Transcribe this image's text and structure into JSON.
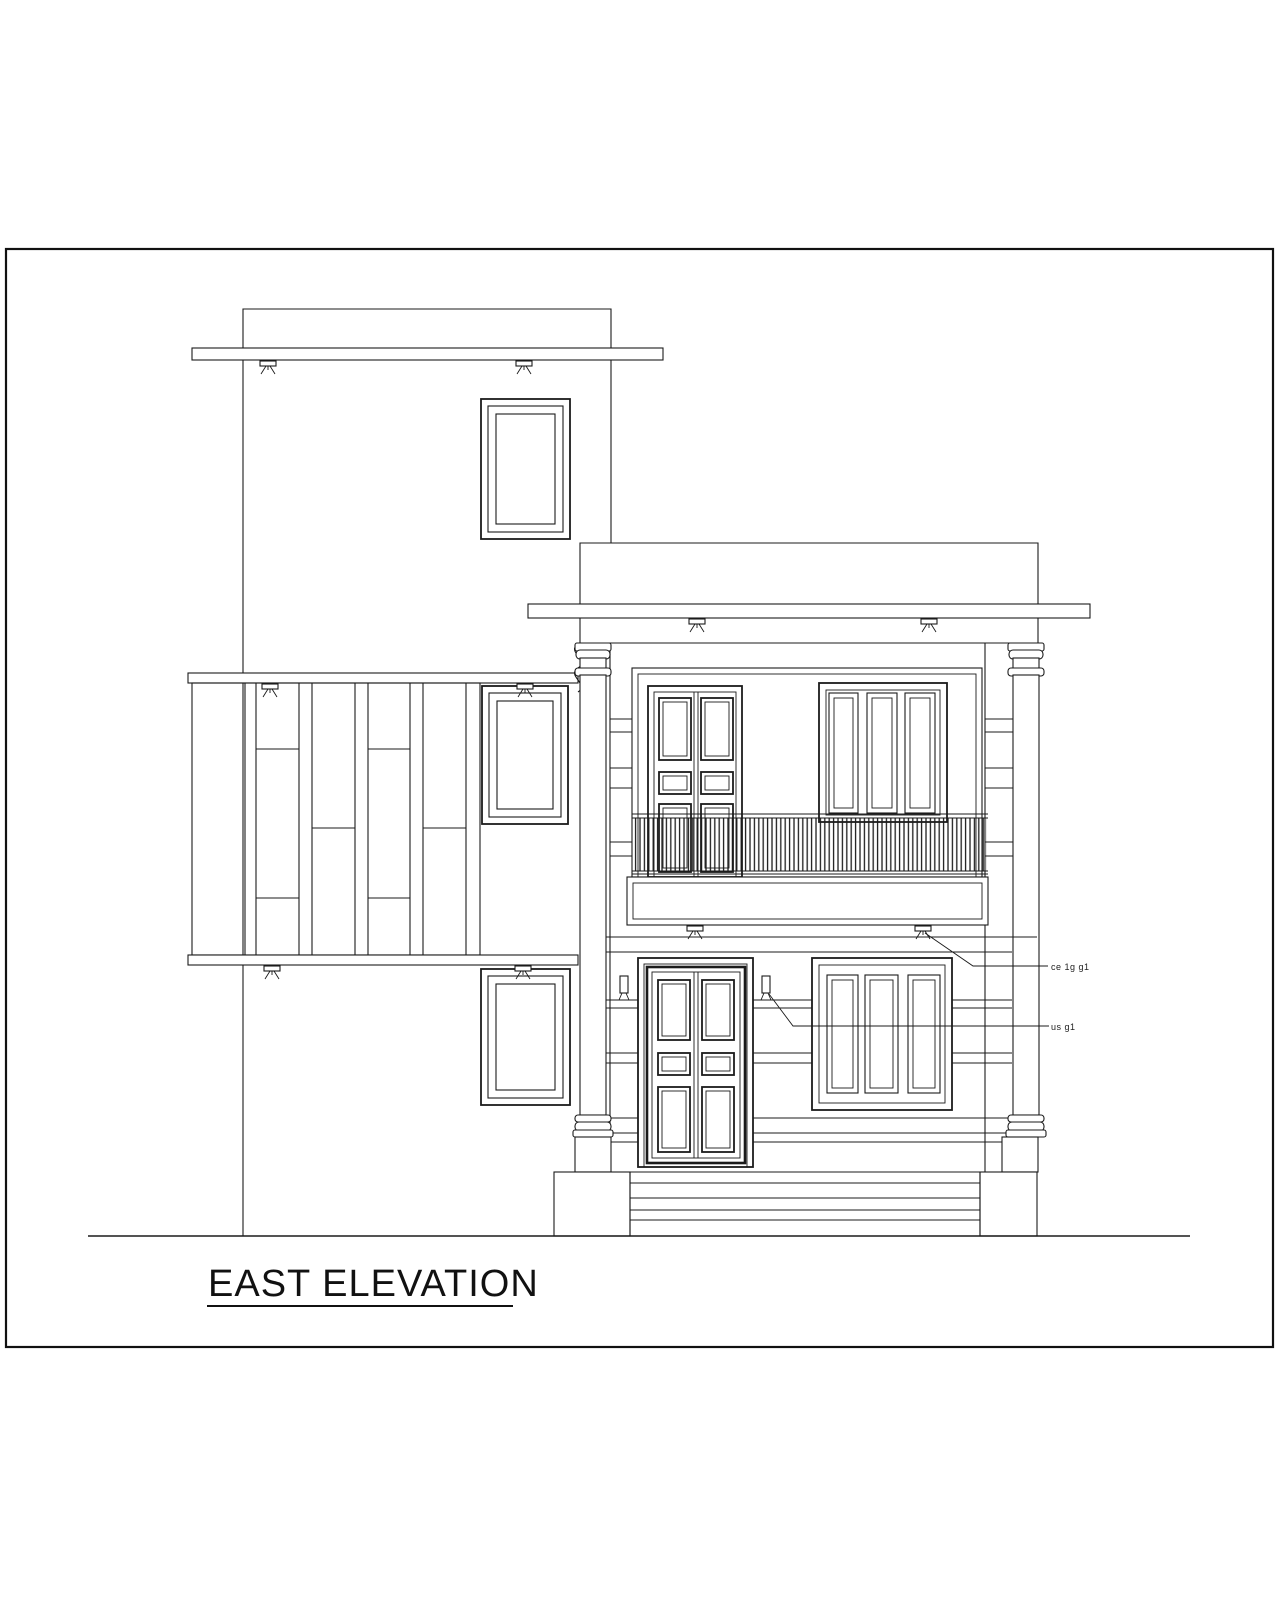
{
  "page": {
    "background": "#ffffff",
    "line_color": "#1b1b1b"
  },
  "drawing": {
    "title": "EAST ELEVATION",
    "annotations": {
      "roof_note": "ce 1g g1",
      "wall_note": "us g1"
    },
    "symbols": {
      "rain_spout": "rain-water-spout-icon",
      "wall_lamp": "wall-light-icon"
    }
  }
}
